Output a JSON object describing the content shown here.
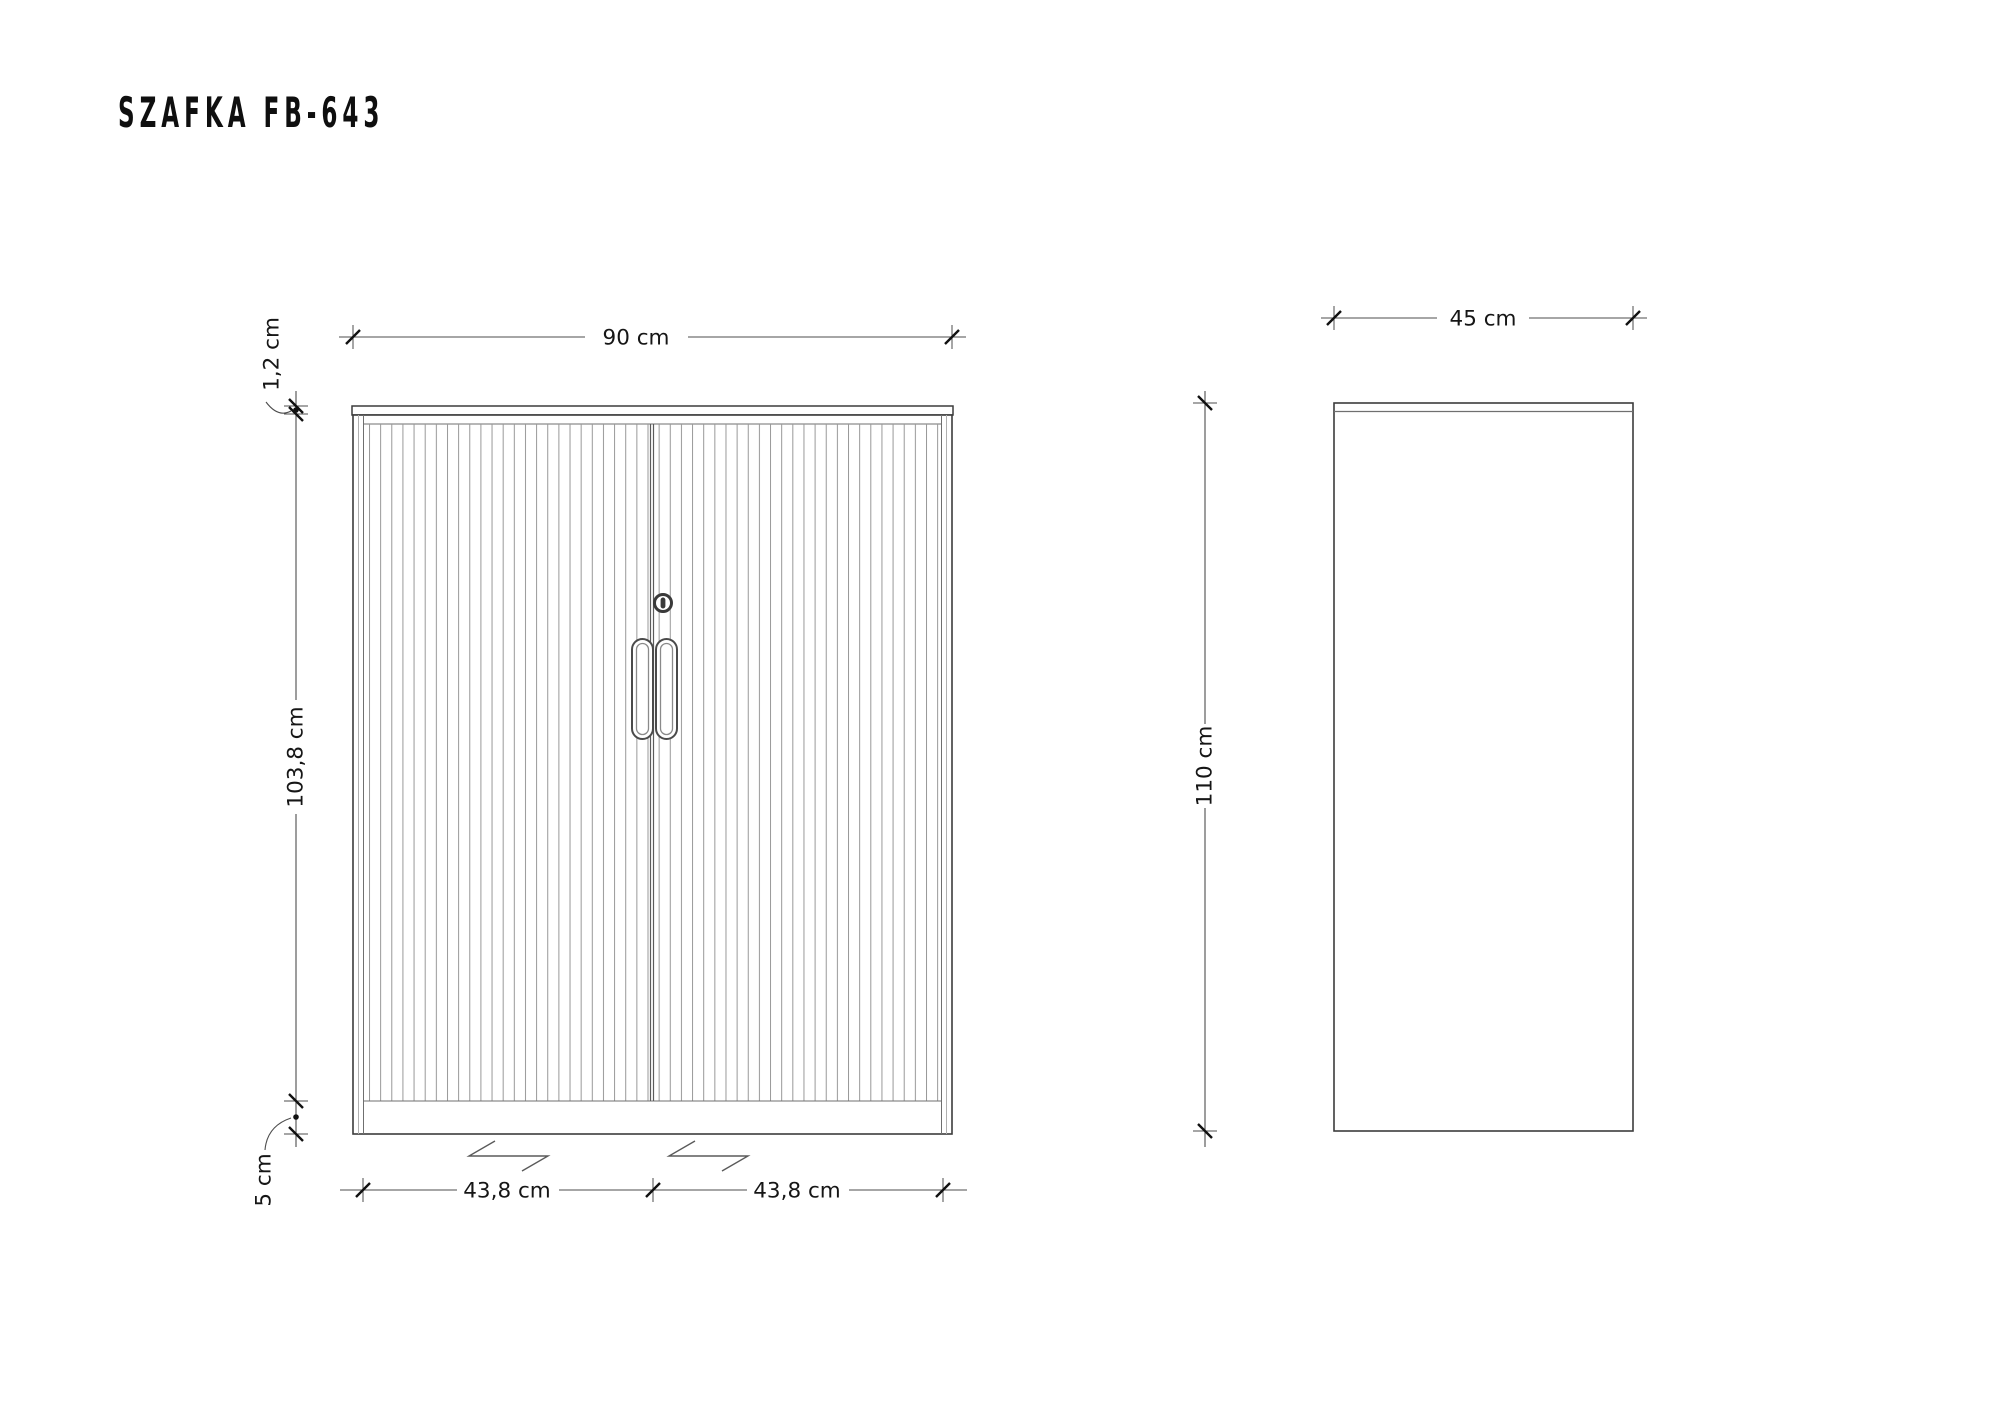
{
  "title": "SZAFKA FB-643",
  "dimensions": {
    "front": {
      "width": "90 cm",
      "top_panel": "1,2 cm",
      "body_height": "103,8 cm",
      "plinth": "5 cm",
      "left_door": "43,8 cm",
      "right_door": "43,8 cm"
    },
    "side": {
      "depth": "45 cm",
      "height": "110 cm"
    }
  },
  "colors": {
    "background": "#ffffff",
    "outline": "#3c3c3c",
    "inner_line": "#6f6f6f",
    "slat_line": "#989898",
    "dimension_line": "#4d4d4d",
    "tick": "#111111",
    "text": "#161616"
  }
}
